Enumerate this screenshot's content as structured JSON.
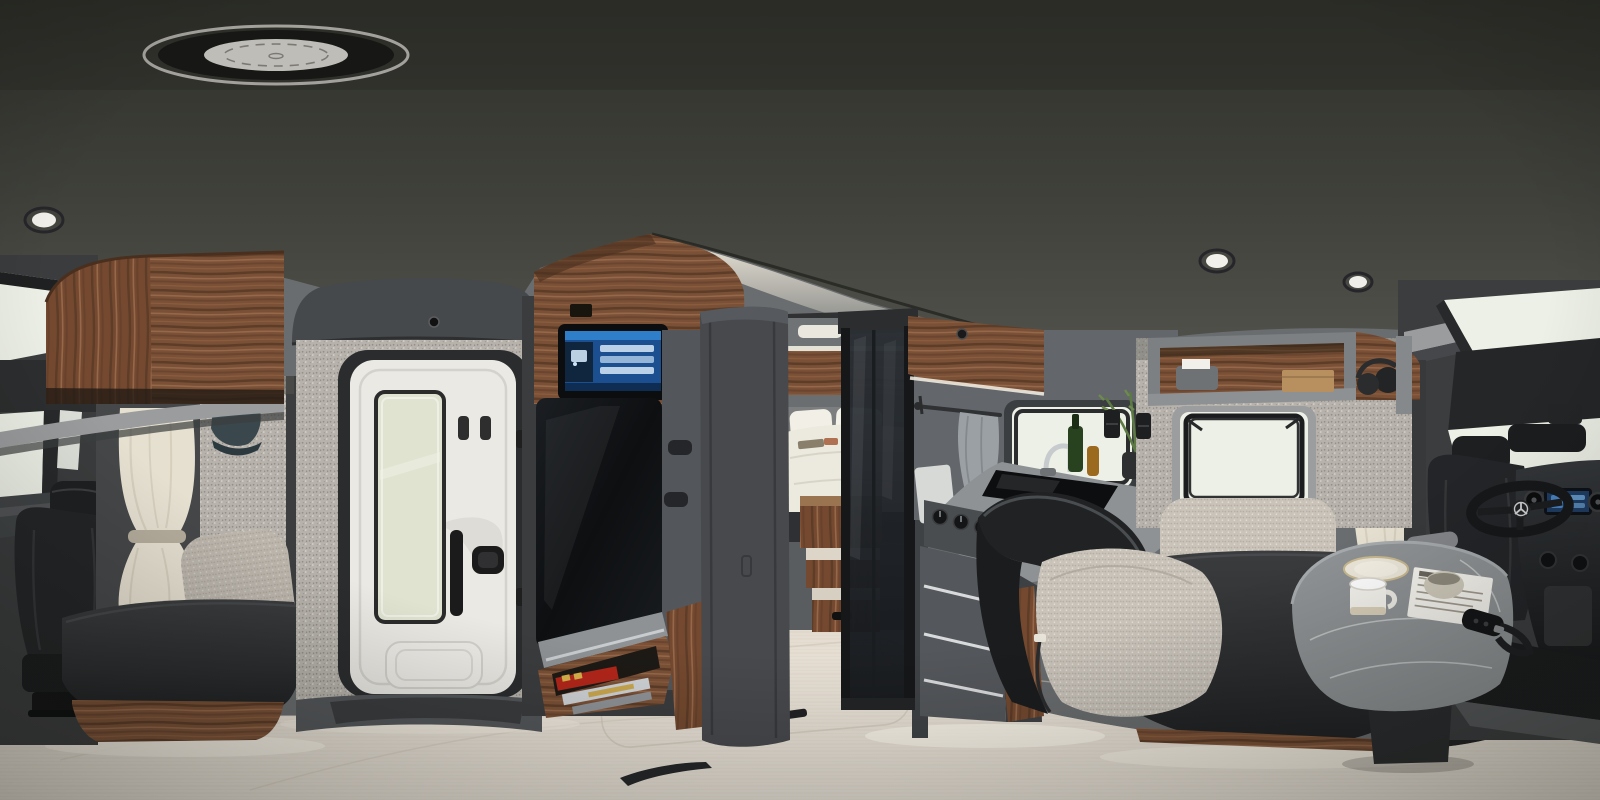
{
  "meta": {
    "type": "equirectangular-360-panorama-render",
    "subject": "luxury motorhome (RV) interior, walnut wood and grey trim",
    "width_px": 1600,
    "height_px": 800,
    "visible_text": "none legible (magazine spines and control screens too small to read)"
  },
  "palette": {
    "ceiling_top": "#31322c",
    "ceiling_bottom": "#4c4d46",
    "cove_glow": "#efe9da",
    "wall_gray": "#6a6d6f",
    "wall_dark": "#4a4d50",
    "speckle_base": "#b7b3ac",
    "speckle_dot_dark": "#948f88",
    "speckle_dot_light": "#ddd9d1",
    "wood_dark": "#5d3c28",
    "wood_mid": "#7a5136",
    "wood_light": "#96684a",
    "floor_base": "#e9e2d7",
    "floor_grain": "#d6ccbe",
    "floor_glow": "#fdf8ec",
    "door_white": "#eae9e4",
    "door_glass": "#dfe3d0",
    "frame_dark": "#2c2e30",
    "tv_black": "#101214",
    "screen_blue": "#2f7ec9",
    "screen_blue_dark": "#15375e",
    "marble_gray": "#8e9294",
    "marble_vein": "#e8eaea",
    "bench_dark": "#2b2d2f",
    "boucle": "#c9c3ba",
    "leather_black": "#202224",
    "curtain_cream": "#e6e0d1",
    "window_bright": "#edf0e6",
    "metal_chrome": "#c9ccce",
    "accent_red": "#b3261a",
    "accent_gold": "#d9b24a",
    "plant_green": "#5d7a44",
    "cap_teal": "#3a484d",
    "towel_gray": "#9aa0a4"
  },
  "scene": {
    "ceiling": [
      "roof-fan-skylight",
      "recessed-light-left",
      "recessed-light-right-1",
      "recessed-light-right-2",
      "led-cove-strip"
    ],
    "left_section": [
      "cab-skylight",
      "windshield",
      "cab-seat",
      "cream-curtain",
      "overhead-walnut-cabinet",
      "headliner-shelf",
      "hanging-cap",
      "speckled-wall",
      "boucle-pillow",
      "lounge-bench",
      "walnut-plinth"
    ],
    "bathroom_pod": [
      "grey-cowl",
      "sensor-dot",
      "speckled-wall",
      "white-door",
      "frosted-glass-panel",
      "vent-slots",
      "door-handle",
      "door-lock",
      "moulded-step",
      "plinth"
    ],
    "media_unit": [
      "walnut-top-cabinet",
      "control-touchscreen",
      "tv-panel",
      "grey-frame-handles",
      "marble-shelf",
      "magazine-rack",
      "magazines-red-gold",
      "walnut-base"
    ],
    "bedroom": [
      "doorway-pillar",
      "header-led",
      "ceiling-lamp",
      "overhead-cabinets",
      "bed-white-linens",
      "pillows",
      "walnut-steps",
      "step-latch"
    ],
    "shower": [
      "tinted-glass-door",
      "black-frame-rails"
    ],
    "kitchen": [
      "towel-rail",
      "hand-towel",
      "cutting-board",
      "awning-window",
      "walnut-upper-panel",
      "speaker-dot",
      "marble-counter",
      "black-glass-cooktop",
      "faucet",
      "oil-bottles",
      "herb-plant",
      "control-knobs",
      "oven-front",
      "drawer-stack-led",
      "floor-led-glow"
    ],
    "dinette": [
      "speckled-wall",
      "wall-switches",
      "awning-window-open",
      "open-shelf",
      "tissue-box",
      "wooden-box",
      "headphones",
      "leather-bolster",
      "walnut-side-panel",
      "boucle-seat-cushion",
      "boucle-back-cushion",
      "charcoal-bench",
      "walnut-kickboard",
      "marble-table",
      "ceramic-plate",
      "white-mug",
      "stone-bowl",
      "newspaper",
      "key-fob-with-strap"
    ],
    "cab_right": [
      "overcab-shelf",
      "cab-skylight",
      "windshield",
      "rearview-mirror",
      "cream-curtain",
      "driver-seat",
      "armrest",
      "steering-wheel-star-emblem",
      "dashboard",
      "infotainment-screen",
      "round-air-vents",
      "center-console"
    ],
    "floor": [
      "light-oak-plank-floor",
      "floor-hatch-outlines",
      "black-hatch-latches",
      "ambient-led-glow"
    ]
  }
}
